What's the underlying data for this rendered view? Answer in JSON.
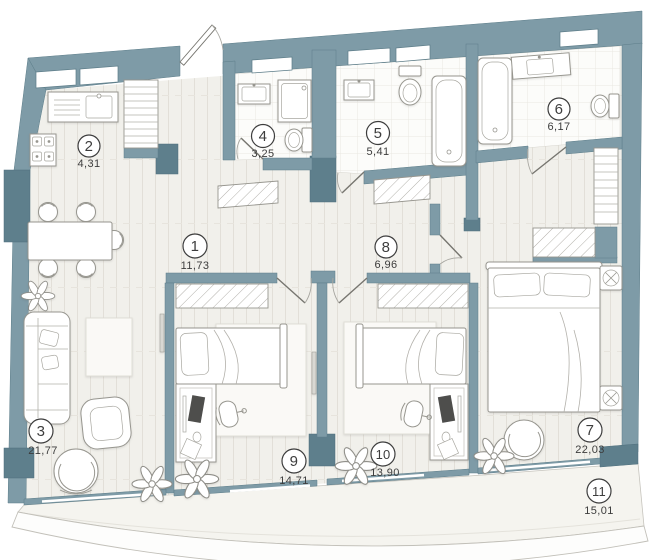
{
  "plan": {
    "type": "apartment-floor-plan",
    "colors": {
      "wall": "#7E9BA7",
      "wall_dark": "#5E7F8C",
      "floor": "#F1F0EB",
      "tile": "#FCFCFA",
      "outline": "#97968F",
      "label_text": "#3D3D3D"
    },
    "rooms": [
      {
        "id": 1,
        "number": "1",
        "area": "11,73"
      },
      {
        "id": 2,
        "number": "2",
        "area": "4,31"
      },
      {
        "id": 3,
        "number": "3",
        "area": "21,77"
      },
      {
        "id": 4,
        "number": "4",
        "area": "3,25"
      },
      {
        "id": 5,
        "number": "5",
        "area": "5,41"
      },
      {
        "id": 6,
        "number": "6",
        "area": "6,17"
      },
      {
        "id": 7,
        "number": "7",
        "area": "22,03"
      },
      {
        "id": 8,
        "number": "8",
        "area": "6,96"
      },
      {
        "id": 9,
        "number": "9",
        "area": "14,71"
      },
      {
        "id": 10,
        "number": "10",
        "area": "13,90"
      },
      {
        "id": 11,
        "number": "11",
        "area": "15,01"
      }
    ]
  }
}
